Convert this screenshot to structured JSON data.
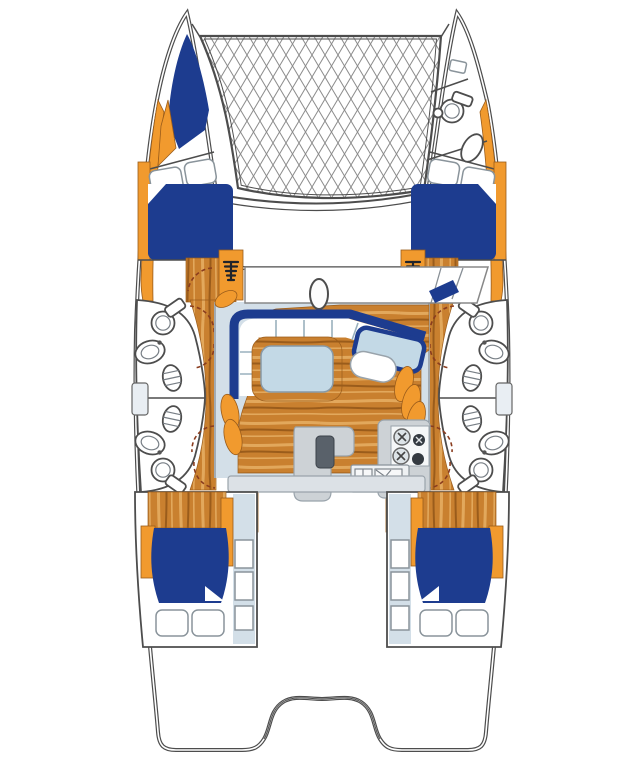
{
  "title": "Catamaran interior layout floor plan",
  "diagram_type": "boat-floorplan-top-view",
  "colors": {
    "navy": "#1d3c8f",
    "orange": "#f19a2e",
    "wood": "#c9802f",
    "wood_light": "#e2a85c",
    "wood_dark": "#9a5c1b",
    "deck": "#d3dfe8",
    "table_top": "#c3d9e6",
    "counter": "#cdd2d6",
    "outline": "#4d4d4d",
    "mesh": "#8c8c8c",
    "door": "#8a3c1e",
    "fixture_dark": "#20242b"
  },
  "features": [
    {
      "id": "trampoline",
      "label": "bow trampoline net",
      "shape": "diamond-mesh"
    },
    {
      "id": "port-bow-berth",
      "label": "port bow V-berth"
    },
    {
      "id": "starboard-bow-head",
      "label": "starboard bow washroom with toilet and basin"
    },
    {
      "id": "port-forward-cabin",
      "label": "port forward double berth with two pillows"
    },
    {
      "id": "starboard-forward-cabin",
      "label": "starboard forward double berth with two pillows"
    },
    {
      "id": "port-hull-bathrooms",
      "label": "port hull twin bathrooms: toilets, basins, shower grates"
    },
    {
      "id": "starboard-hull-bathrooms",
      "label": "starboard hull twin bathrooms: toilets, basins, shower grates"
    },
    {
      "id": "saloon-settee",
      "label": "U-shaped saloon settee with white cushions"
    },
    {
      "id": "saloon-table",
      "label": "wood-rimmed saloon table"
    },
    {
      "id": "nav-station",
      "label": "chart table with seat and orange cushions"
    },
    {
      "id": "galley",
      "label": "galley: L-island, 4-burner stove, twin sink"
    },
    {
      "id": "companionway-steps",
      "label": "companionway steps (4 sets)"
    },
    {
      "id": "port-aft-cabin",
      "label": "port aft double cabin"
    },
    {
      "id": "starboard-aft-cabin",
      "label": "starboard aft double cabin"
    },
    {
      "id": "mast-step",
      "label": "mast oval at saloon front"
    },
    {
      "id": "foredeck-hatches",
      "label": "foredeck hatch pairs"
    }
  ]
}
